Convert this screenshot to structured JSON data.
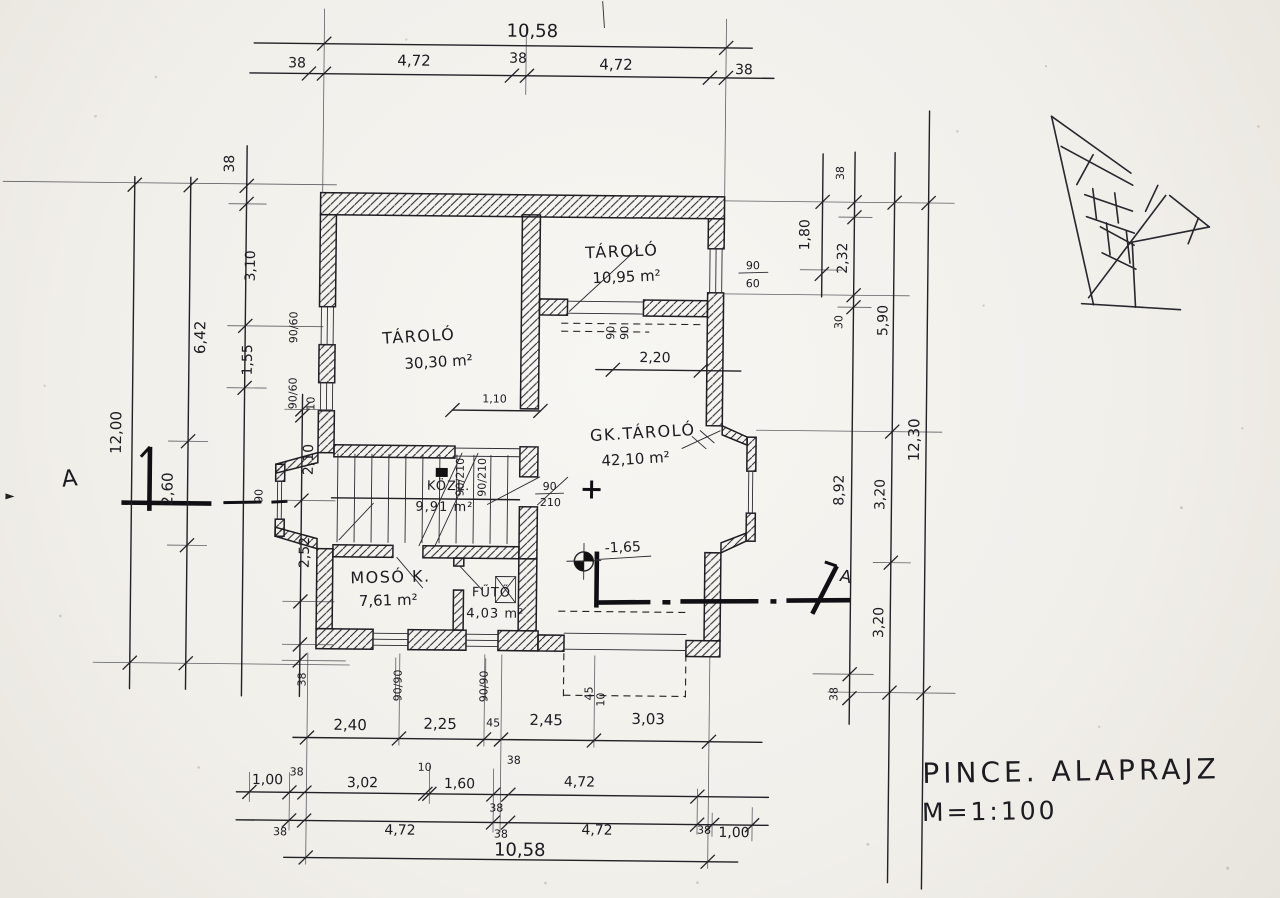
{
  "title": {
    "name": "PINCE. ALAPRAJZ",
    "scale": "M=1:100"
  },
  "section": {
    "left_label": "A",
    "right_label": "A"
  },
  "level": {
    "value": "-1,65"
  },
  "rooms": {
    "storage_main": {
      "name": "TÁROLÓ",
      "area": "30,30 m²"
    },
    "storage_top": {
      "name": "TÁROLÓ",
      "area": "10,95 m²"
    },
    "gk_storage": {
      "name": "GK.TÁROLÓ",
      "area": "42,10 m²"
    },
    "hall": {
      "name": "KÖZL.",
      "area": "9,91 m²"
    },
    "laundry": {
      "name": "MOSÓ K.",
      "area": "7,61 m²"
    },
    "boiler": {
      "name": "FŰTŐ",
      "area": "4,03 m²"
    }
  },
  "dims": {
    "top_total": "10,58",
    "top": [
      "38",
      "4,72",
      "38",
      "4,72",
      "38"
    ],
    "left_outer": "12,00",
    "left_mid": [
      "6,42",
      "2,60"
    ],
    "left_inner": [
      "38",
      "3,10",
      "1,55"
    ],
    "left_inner2": [
      "10",
      "2,10",
      "2,52",
      "38"
    ],
    "right_180": "1,80",
    "right_inner": [
      "38",
      "2,32",
      "30",
      "8,92",
      "38"
    ],
    "right_mid": [
      "5,90",
      "3,20",
      "3,20"
    ],
    "right_outer": "12,30",
    "bottom1": [
      "2,40",
      "2,25",
      "45",
      "2,45",
      "3,03"
    ],
    "bottom1_38": "38",
    "bottom2": [
      "1,00",
      "38",
      "3,02",
      "10",
      "1,60",
      "38",
      "4,72"
    ],
    "bottom3": [
      "38",
      "4,72",
      "38",
      "4,72",
      "38",
      "1,00"
    ],
    "bottom_total": "10,58",
    "inner_110": "1,10",
    "inner_220": "2,20"
  },
  "openings": {
    "win_right_w": "90",
    "win_right_h": "60",
    "door_gk_w": "90",
    "door_gk_h": "210",
    "door_rot_1": "90/210",
    "door_rot_2": "90/210",
    "win_top_a": "90",
    "win_top_b": "90",
    "win_left_upper": "90/60",
    "win_left_lower": "90/60",
    "win_bay": "90",
    "win_bottom_1": "90/90",
    "win_bottom_2": "90/90",
    "small_a": "45",
    "small_b": "10"
  }
}
